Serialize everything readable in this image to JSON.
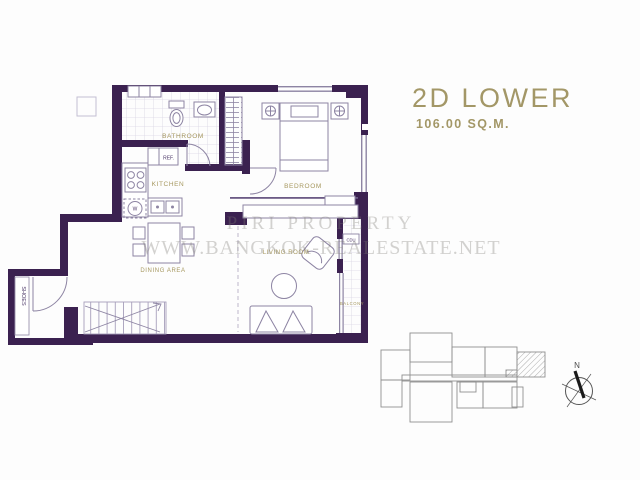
{
  "header": {
    "title": "2D LOWER",
    "area": "106.00 SQ.M."
  },
  "watermark": {
    "line1": "PIRI PROPERTY",
    "line2": "WWW.BANGKOK-REALESTATE.NET"
  },
  "rooms": {
    "bathroom": "BATHROOM",
    "kitchen": "KITCHEN",
    "bedroom": "BEDROOM",
    "dining_area": "DINING AREA",
    "living_room": "LIVING ROOM",
    "balcony": "BALCONY",
    "shoes": "SHOES"
  },
  "fixtures": {
    "refrigerator": "REF.",
    "condenser": "CDU",
    "washer": "W"
  },
  "keyplan": {
    "north": "N"
  },
  "colors": {
    "wall": "#3b2150",
    "title_gold": "#a39767",
    "label_gold": "#a6985f",
    "furniture_line": "#8d84a3",
    "tile_line": "#d9d5e3",
    "watermark_gray": "#c7c5c2",
    "keyplan_line": "#8f8f8f"
  }
}
